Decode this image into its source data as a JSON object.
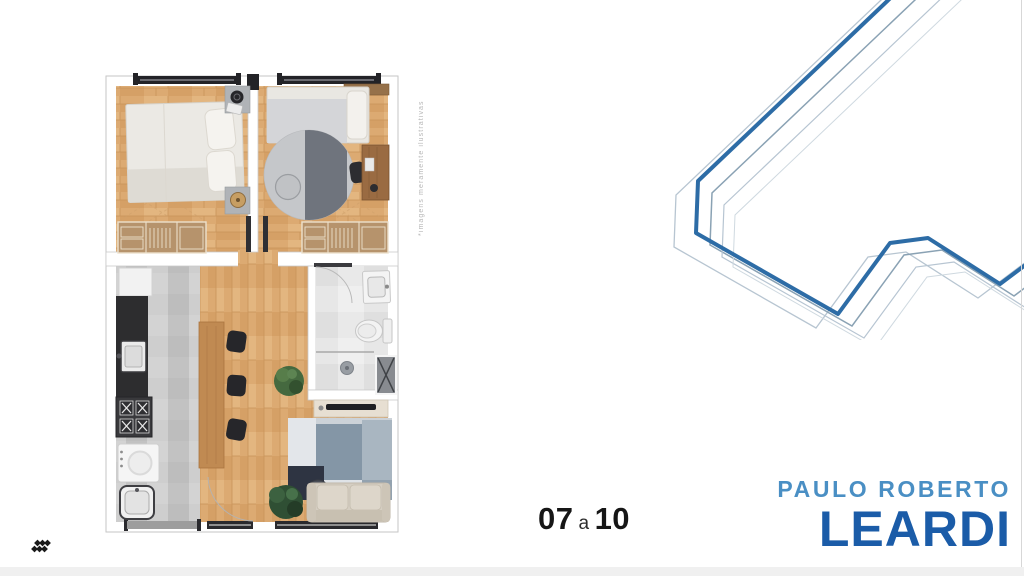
{
  "floor_plan": {
    "caption": "*imagens meramente ilustrativas"
  },
  "unit_range": {
    "from": "07",
    "connector": "a",
    "to": "10"
  },
  "brand": {
    "line1": "PAULO ROBERTO",
    "line2": "LEARDI"
  },
  "icons": {
    "bottom_left": "diamond-cluster-icon"
  },
  "colors": {
    "accentBlue": "#2d6ca6",
    "brandLight": "#4a8fc4",
    "brandDark": "#1b5ca8",
    "echoGray": "#8aa2b4",
    "wood": "#dcaa72",
    "kitchenTile": "#c7c7c7",
    "bathTile": "#e7e7e7",
    "closetTan": "#b6936c",
    "counterDark": "#2d2d2f",
    "rugNavy": "#2e3442",
    "rugBlue": "#8496a6",
    "sofaBeige": "#d5cec2",
    "plantGreen": "#45693f",
    "textDark": "#161616",
    "captionGray": "#b7b7b7"
  }
}
